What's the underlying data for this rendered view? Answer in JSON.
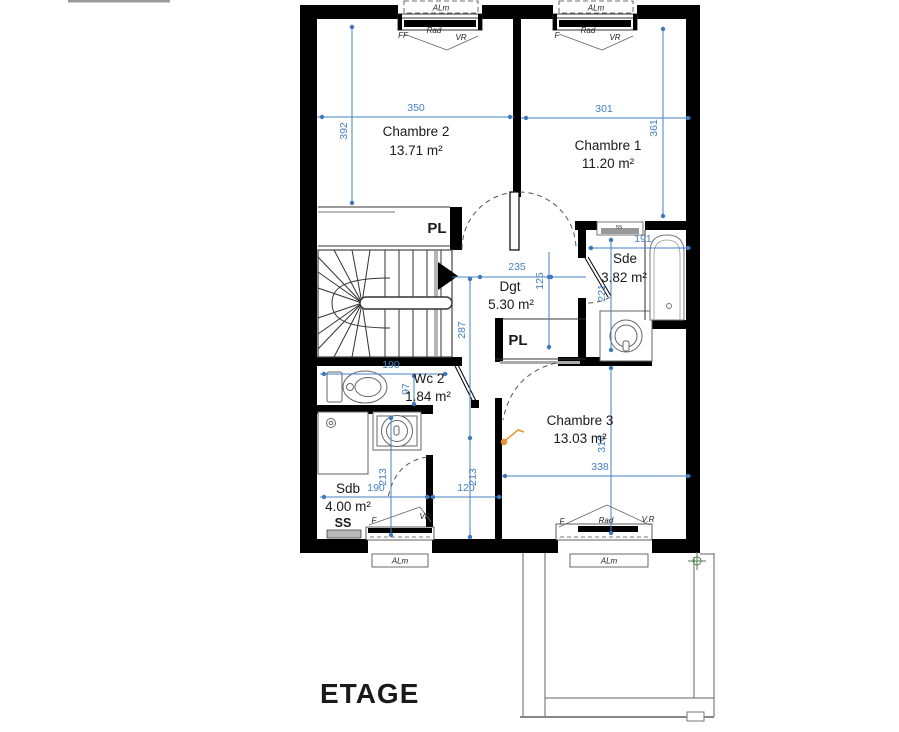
{
  "title": "ETAGE",
  "colors": {
    "wall": "#000000",
    "dimension_blue": "#4480c4",
    "handle_orange": "#e8932f",
    "marker_green": "#4e7e4e"
  },
  "rooms": {
    "ch2": {
      "name": "Chambre 2",
      "area": "13.71 m²"
    },
    "ch1": {
      "name": "Chambre 1",
      "area": "11.20 m²"
    },
    "dgt": {
      "name": "Dgt",
      "area": "5.30 m²"
    },
    "sde": {
      "name": "Sde",
      "area": "3.82 m²"
    },
    "wc2": {
      "name": "Wc 2",
      "area": "1.84 m²"
    },
    "ch3": {
      "name": "Chambre 3",
      "area": "13.03 m²"
    },
    "sdb": {
      "name": "Sdb",
      "area": "4.00 m²"
    }
  },
  "closets": {
    "pl_top": "PL",
    "pl_mid": "PL"
  },
  "shelves": {
    "sdb_ss": "SS",
    "sde_ss": "ss"
  },
  "windows": {
    "top_left": {
      "alm": "ALm",
      "l": "FF",
      "m": "Rad",
      "r": "VR"
    },
    "top_right": {
      "alm": "ALm",
      "l": "F",
      "m": "Rad",
      "r": "VR"
    },
    "bottom_left": {
      "alm": "ALm",
      "l": "F",
      "r": "VR"
    },
    "bottom_right": {
      "alm": "ALm",
      "l": "F",
      "m": "Rad",
      "r": "V.R"
    }
  },
  "dims": {
    "d350": "350",
    "d392": "392",
    "d301": "301",
    "d361": "361",
    "d235": "235",
    "d125": "125",
    "d287": "287",
    "d221": "221",
    "d191": "191",
    "d190wc": "190",
    "d97": "97",
    "d213sdb": "213",
    "d213hall": "213",
    "d190sdb": "190",
    "d120": "120",
    "d338": "338",
    "d310": "310"
  }
}
